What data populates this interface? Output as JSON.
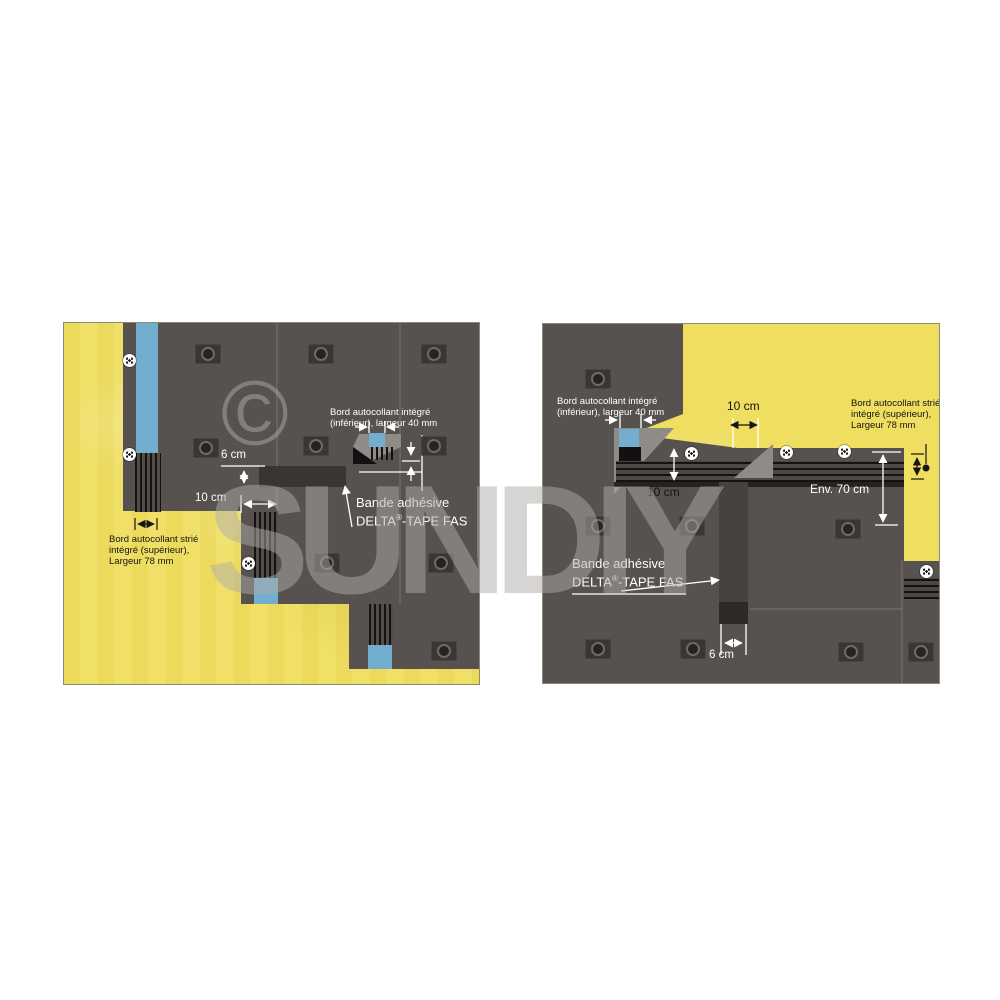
{
  "image_type": "product installation diagram, two panels",
  "watermark": {
    "copyright_symbol": "©",
    "brand_text": "SUNDIY"
  },
  "colors": {
    "insulation_yellow": "#efde60",
    "membrane_dark": "#575150",
    "adhesive_blue": "#74aecf",
    "fold_flap_gray": "#8f8c88",
    "tape_dark": "#3a3532",
    "page_background": "#ffffff"
  },
  "diagram_left": {
    "label_edge_lower_line1": "Bord autocollant intégré",
    "label_edge_lower_line2": "(inférieur), largeur 40 mm",
    "label_tape_line1": "Bande adhésive",
    "label_tape_brand": "DELTA",
    "label_tape_reg": "®",
    "label_tape_suffix": "-TAPE FAS",
    "label_edge_upper_line1": "Bord autocollant strié",
    "label_edge_upper_line2": "intégré (supérieur),",
    "label_edge_upper_line3": "Largeur 78 mm",
    "dim_6cm": "6 cm",
    "dim_10cm": "10 cm"
  },
  "diagram_right": {
    "label_edge_lower_line1": "Bord autocollant intégré",
    "label_edge_lower_line2": "(inférieur), largeur 40 mm",
    "label_edge_upper_line1": "Bord autocollant strié",
    "label_edge_upper_line2": "intégré (supérieur),",
    "label_edge_upper_line3": "Largeur 78 mm",
    "label_tape_line1": "Bande adhésive",
    "label_tape_brand": "DELTA",
    "label_tape_reg": "®",
    "label_tape_suffix": "-TAPE FAS",
    "dim_10cm_top": "10 cm",
    "dim_10cm_left": "10 cm",
    "dim_env_70cm": "Env. 70 cm",
    "dim_6cm": "6 cm"
  }
}
